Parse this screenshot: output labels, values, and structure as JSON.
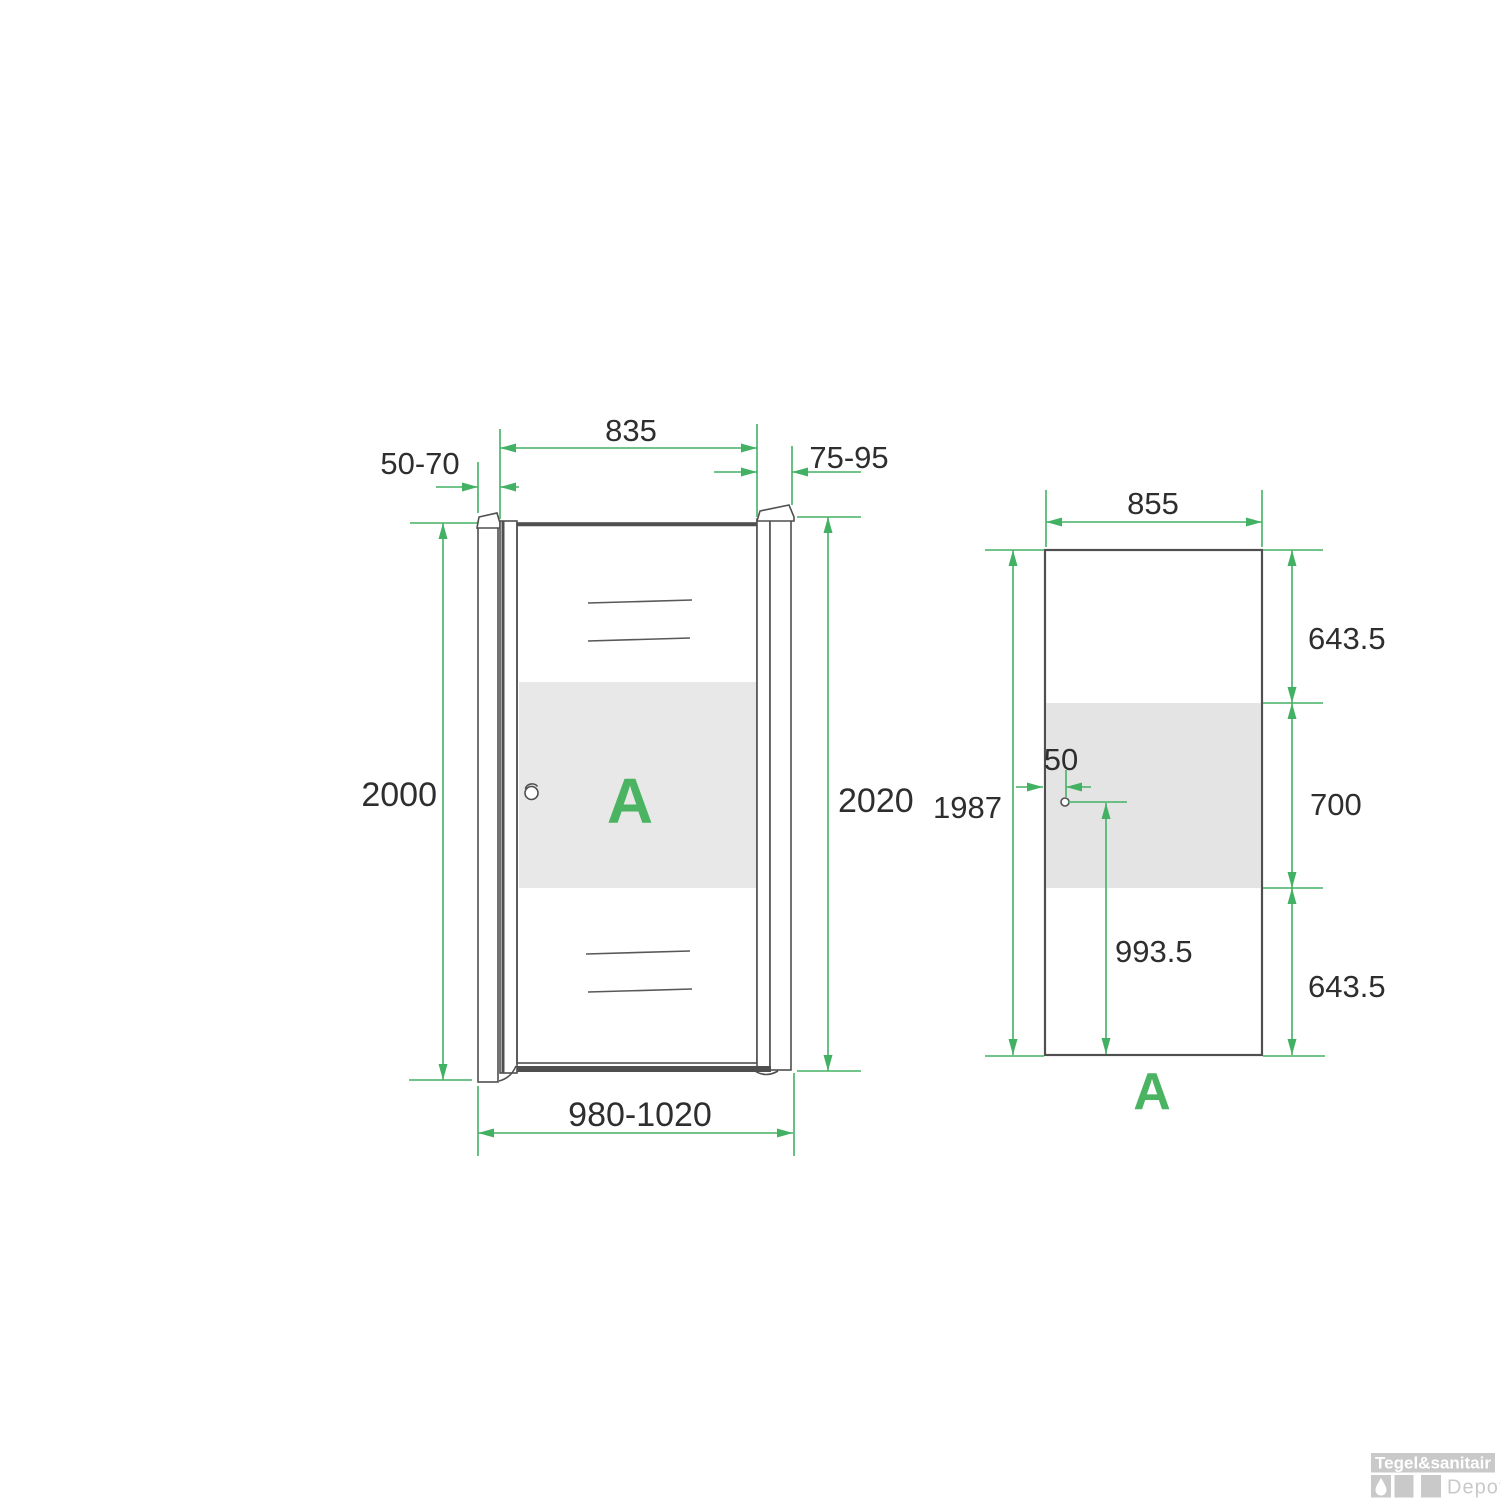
{
  "front": {
    "panel_letter": "A",
    "dim_top_width": "835",
    "dim_wall_profile_left": "50-70",
    "dim_wall_profile_right": "75-95",
    "dim_height_left": "2000",
    "dim_height_right": "2020",
    "dim_total_width": "980-1020"
  },
  "glass": {
    "panel_letter": "A",
    "dim_width": "855",
    "dim_clear_top": "643.5",
    "dim_frosted_band": "700",
    "dim_clear_bottom": "643.5",
    "dim_height": "1987",
    "dim_handle_edge_offset": "50",
    "dim_handle_from_bottom": "993.5"
  },
  "watermark": {
    "brand": "Tegel&sanitair",
    "sub_brand": "Depot",
    "icon": "water-drop-icon"
  },
  "colors": {
    "dimension_green": "#43b164",
    "accent_green": "#4bb462",
    "line_gray": "#4f4f4f",
    "frost_gray": "#e8e8e8"
  }
}
